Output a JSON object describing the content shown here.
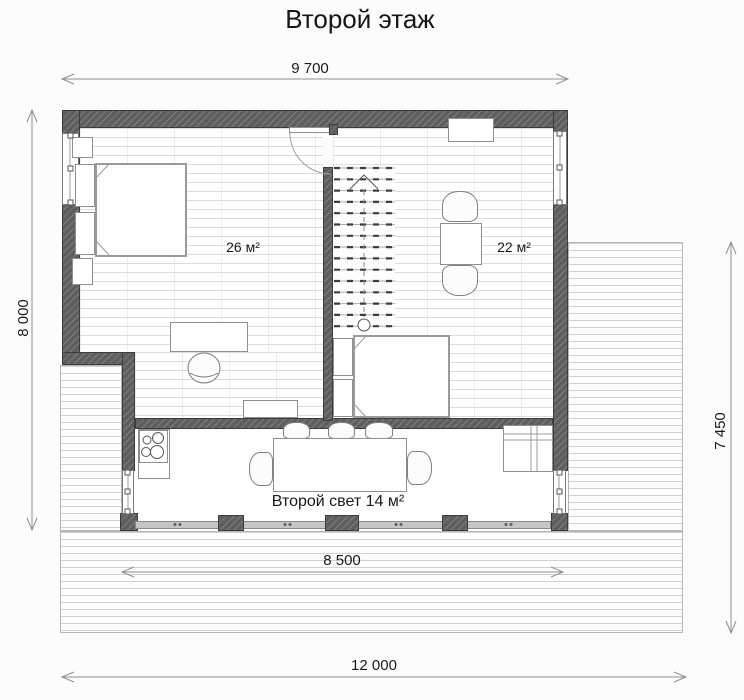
{
  "title": "Второй этаж",
  "dimensions": {
    "top": "9 700",
    "left": "8 000",
    "right": "7 450",
    "inner_bottom": "8 500",
    "outer_bottom": "12 000"
  },
  "rooms": {
    "bedroom_left_area": "26 м²",
    "room_right_area": "22 м²",
    "second_light_label": "Второй свет 14 м²"
  },
  "colors": {
    "wall": "#5e5e5e",
    "floor_line": "#dcdcdc",
    "deck_line": "#d2d2d2",
    "dimension_line": "#8f8f8f",
    "text": "#141414"
  }
}
